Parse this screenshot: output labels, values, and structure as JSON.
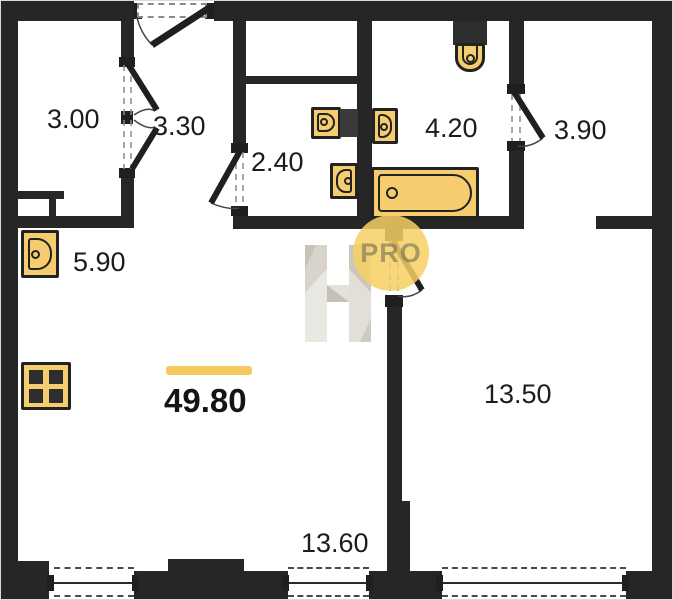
{
  "plan": {
    "total_area": "49.80",
    "rooms": [
      {
        "name": "closet",
        "area": "3.00"
      },
      {
        "name": "entry-vestibule",
        "area": "3.30"
      },
      {
        "name": "wc",
        "area": "2.40"
      },
      {
        "name": "bathroom",
        "area": "4.20"
      },
      {
        "name": "hall",
        "area": "3.90"
      },
      {
        "name": "corridor",
        "area": "5.90"
      },
      {
        "name": "living-room",
        "area": "13.50"
      },
      {
        "name": "kitchen-living",
        "area": "13.60"
      }
    ]
  },
  "watermark": {
    "logo_letter": "H",
    "badge_label": "PRO"
  },
  "icons": [
    "sink-icon",
    "stove-icon",
    "toilet-icon",
    "bathtub-icon",
    "washing-machine-icon",
    "door-swing-icon",
    "window-icon",
    "folding-door-icon"
  ],
  "colors": {
    "background": "#ffffff",
    "wall": "#262626",
    "fixture_fill": "#f5cd6e",
    "fixture_outline": "#222222",
    "accent_bar": "#f6c95f",
    "badge_background": "#f6d063",
    "badge_text": "#767058",
    "watermark_light": "#e9e7e1",
    "watermark_dark": "#cfcabf",
    "label_text": "#1c1c1c"
  }
}
